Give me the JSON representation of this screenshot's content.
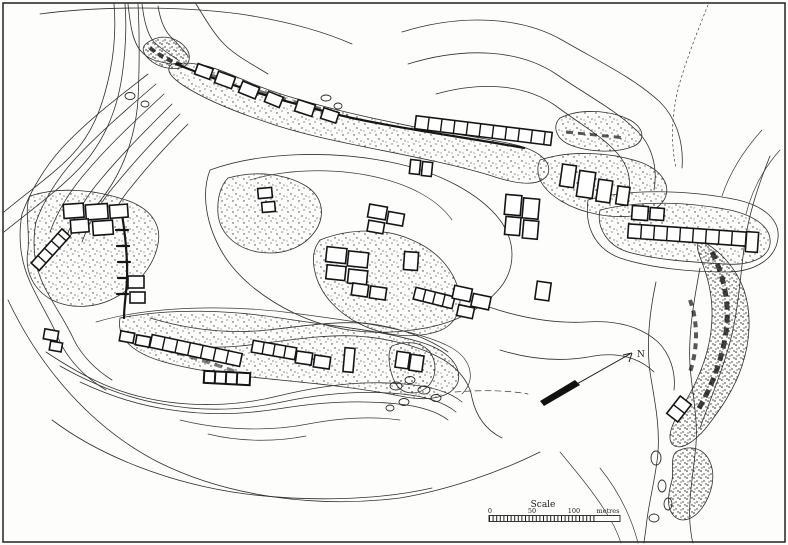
{
  "map": {
    "colors": {
      "ink": "#1c1c1c",
      "paper": "#fdfdfb"
    },
    "north_arrow": {
      "label": "N"
    },
    "scale_bar": {
      "title": "Scale",
      "tick_labels": [
        "0",
        "50",
        "100"
      ],
      "unit_label": "metres"
    }
  }
}
